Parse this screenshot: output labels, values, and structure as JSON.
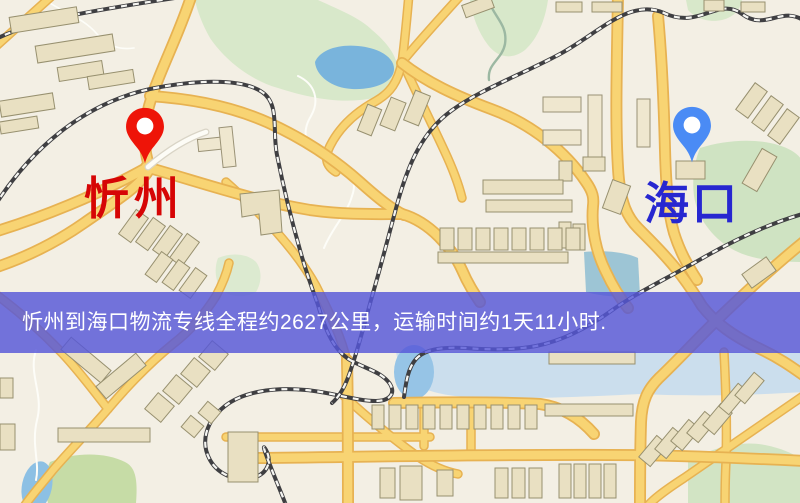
{
  "map": {
    "markers": {
      "origin": {
        "label": "忻州",
        "pin_color": "#ee1408",
        "label_color": "#d60505"
      },
      "destination": {
        "label": "海口",
        "pin_color": "#4a8bf5",
        "label_color": "#2727d0"
      }
    },
    "info_banner": {
      "text": "忻州到海口物流专线全程约2627公里，运输时间约1天11小时.",
      "background_color": "#5557d8",
      "text_color": "#ffffff",
      "route_distance_km": "2627",
      "route_duration": "1天11小时"
    }
  }
}
